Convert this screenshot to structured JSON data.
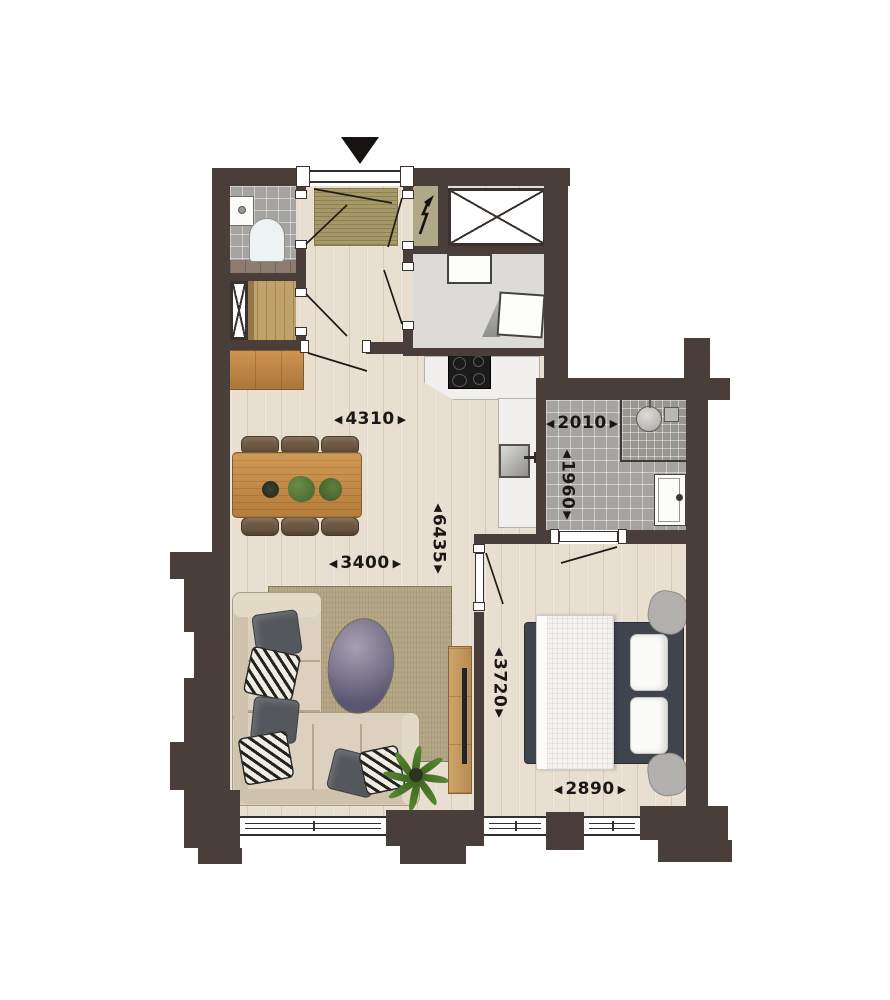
{
  "glyphs": {
    "arrow_left": "◀",
    "arrow_right": "▶",
    "arrow_up": "▲",
    "arrow_down": "▼"
  },
  "dimensions": {
    "living_width": "4310",
    "living_inner_width": "3400",
    "apartment_length": "6435",
    "bathroom_width": "2010",
    "bathroom_depth": "1960",
    "bedroom_depth": "3720",
    "bedroom_width": "2890"
  },
  "colors": {
    "wall": "#4a3e3b",
    "wood": "#e8dfd0",
    "tile": "#a5a4a0",
    "utilityfloor": "#dddbd8",
    "mat": "#a79967",
    "rug": "#b2a482",
    "tablewood": "#c28a47",
    "labeltext": "#1b1715"
  }
}
